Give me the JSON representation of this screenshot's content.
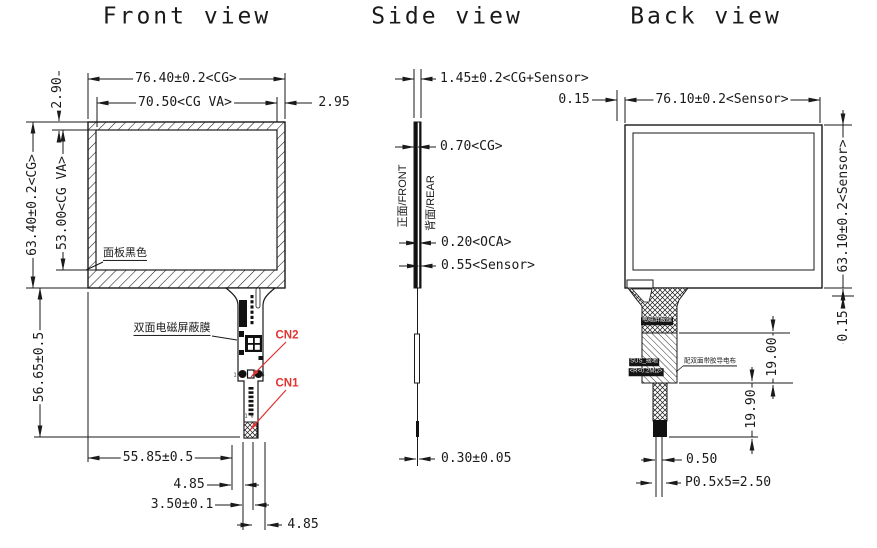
{
  "titles": {
    "front": "Front view",
    "side": "Side view",
    "back": "Back view"
  },
  "front": {
    "dim_width_cg": "76.40±0.2<CG>",
    "dim_width_va": "70.50<CG VA>",
    "dim_side_border": "2.95",
    "dim_top_border": "2.90",
    "dim_height_cg": "63.40±0.2<CG>",
    "dim_height_va": "53.00<CG VA>",
    "dim_tail_length": "56.65±0.5",
    "dim_tail_offset": "55.85±0.5",
    "dim_tail_w1": "4.85",
    "dim_tail_w2": "3.50±0.1",
    "dim_tail_w3": "4.85",
    "label_panel_black": "面板黑色",
    "label_emi_film": "双面电磁屏蔽膜",
    "connector2": "CN2",
    "connector1": "CN1",
    "cn2_pin_left": "1",
    "cn2_pin_right": "6",
    "cn1_pin_marks": "1 6"
  },
  "side": {
    "dim_total": "1.45±0.2<CG+Sensor>",
    "dim_cg": "0.70<CG>",
    "dim_oca": "0.20<OCA>",
    "dim_sensor": "0.55<Sensor>",
    "dim_fpc": "0.30±0.05",
    "label_front_face": "正面/FRONT",
    "label_rear_face": "背面/REAR"
  },
  "back": {
    "dim_width_sensor": "76.10±0.2<Sensor>",
    "dim_left_gap": "0.15",
    "dim_height_sensor": "63.10±0.2<Sensor>",
    "dim_bottom_gap": "0.15",
    "dim_tail_seg1": "19.00",
    "dim_tail_seg2": "19.90",
    "dim_pin_width": "0.50",
    "dim_pin_pitch": "P0.5x5=2.50",
    "label_shield_film": "电磁屏蔽膜",
    "label_sus_ground": "SUS_接地",
    "label_resistance": "<R<0.2MΩ>",
    "label_conductive": "配双面带胶导电布"
  },
  "colors": {
    "line": "#1a1a1a",
    "accent_red": "#e03432"
  }
}
